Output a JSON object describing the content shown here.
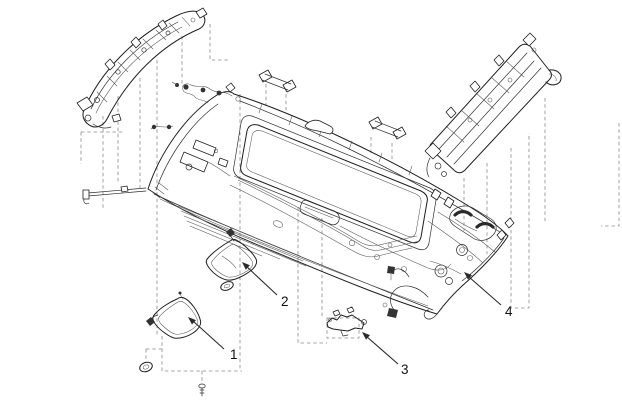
{
  "figure": {
    "background_color": "#ffffff",
    "line_color": "#1f1f1f",
    "dash_color": "#8a8a8a",
    "callouts": [
      {
        "label": "1"
      },
      {
        "label": "2"
      },
      {
        "label": "3"
      },
      {
        "label": "4"
      }
    ]
  }
}
